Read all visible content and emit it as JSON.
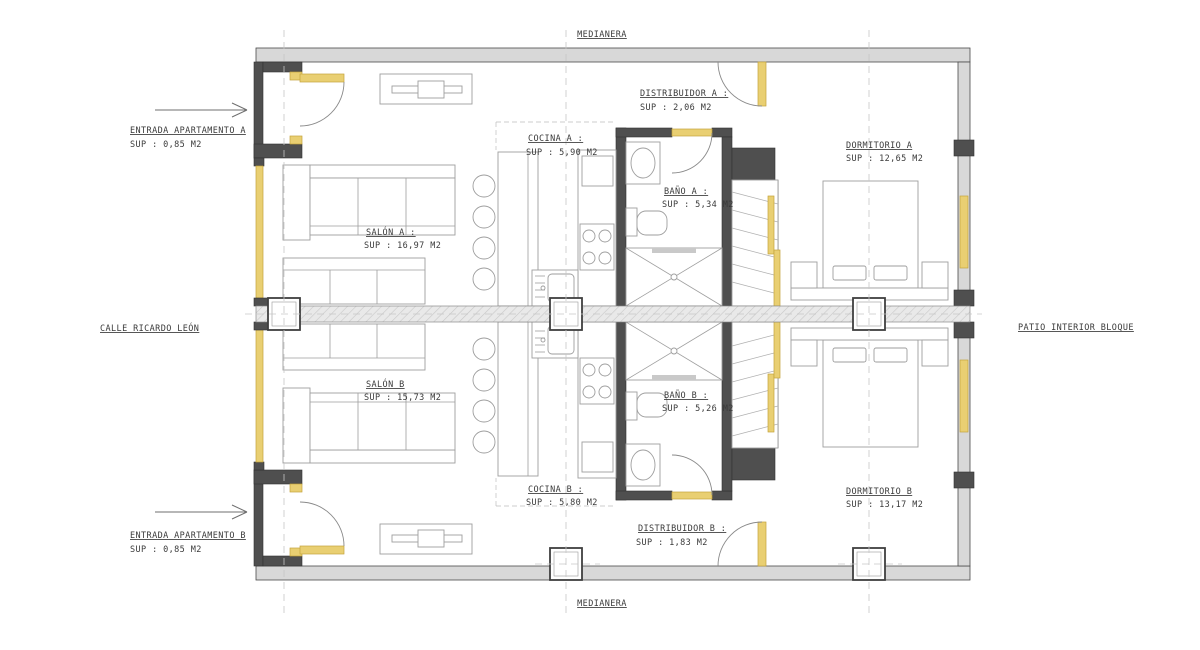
{
  "drawing": {
    "medianera_top": "MEDIANERA",
    "medianera_bottom": "MEDIANERA",
    "street_label": "CALLE RICARDO LEÓN",
    "patio_label": "PATIO INTERIOR BLOQUE",
    "entrance_a": {
      "title": "ENTRADA APARTAMENTO A",
      "area": "SUP : 0,85 M2"
    },
    "entrance_b": {
      "title": "ENTRADA APARTAMENTO B",
      "area": "SUP : 0,85 M2"
    },
    "rooms": {
      "distribuidor_a": {
        "title": "DISTRIBUIDOR A :",
        "area": "SUP : 2,06 M2"
      },
      "cocina_a": {
        "title": "COCINA A :",
        "area": "SUP : 5,90 M2"
      },
      "salon_a": {
        "title": "SALÓN A :",
        "area": "SUP : 16,97 M2"
      },
      "bano_a": {
        "title": "BAÑO A :",
        "area": "SUP : 5,34 M2"
      },
      "dormitorio_a": {
        "title": "DORMITORIO A",
        "area": "SUP : 12,65 M2"
      },
      "distribuidor_b": {
        "title": "DISTRIBUIDOR B :",
        "area": "SUP : 1,83 M2"
      },
      "cocina_b": {
        "title": "COCINA B :",
        "area": "SUP : 5,80 M2"
      },
      "salon_b": {
        "title": "SALÓN B",
        "area": "SUP : 15,73 M2"
      },
      "bano_b": {
        "title": "BAÑO B :",
        "area": "SUP : 5,26 M2"
      },
      "dormitorio_b": {
        "title": "DORMITORIO B",
        "area": "SUP : 13,17 M2"
      }
    },
    "colors": {
      "carpentry_highlight": "#e9cf72",
      "wall_fill": "#d8d8d8",
      "wall_dark": "#4f4f4f",
      "furniture_line": "#9e9e9e",
      "text": "#3a3a3a"
    }
  }
}
